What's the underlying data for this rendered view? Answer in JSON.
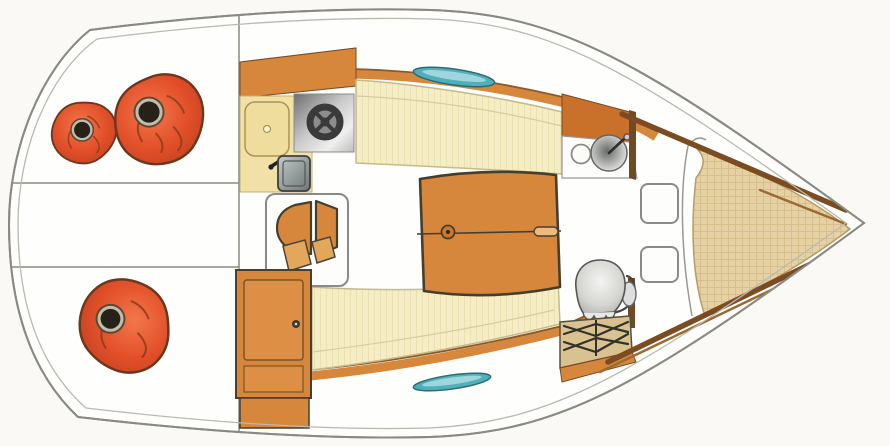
{
  "meta": {
    "title": "Sailboat interior floor plan, top-down view, bow pointing right",
    "diagram_type": "boat-floorplan",
    "orientation": "bow-right"
  },
  "colors": {
    "page-bg": "#FAF9F6",
    "hull-fill": "#FEFEFC",
    "hull-line": "#8A8A82",
    "inner-line": "#B9B9B0",
    "wood": "#D6873B",
    "wood-dark": "#C9702A",
    "wood-edge": "#7A4A22",
    "trim-brown": "#7B4B22",
    "cushion": "#F5EDC6",
    "cushion-edge": "#C6B98A",
    "counter": "#F1E1A6",
    "icebox": "#EEDD9C",
    "berth": "#E5D1A3",
    "berth-edge": "#B59C69",
    "net": "#D9C28F",
    "net-line": "#33312A",
    "window-teal": "#4FB0BC",
    "window-teal-light": "#9FD6DC",
    "window-edge": "#2F6A72",
    "pouf-orange": "#E2502A",
    "pouf-hole": "#262218",
    "pouf-ring": "#C2BCAC",
    "outline-dark": "#463E2D",
    "white": "#FDFDFB"
  },
  "components": {
    "cockpit": {
      "name": "cockpit",
      "bench_divider_lines": 2,
      "poufs": [
        {
          "name": "pouf-small-aft-top"
        },
        {
          "name": "pouf-large-aft-top"
        },
        {
          "name": "pouf-aft-bottom"
        }
      ]
    },
    "galley": {
      "name": "galley",
      "fixtures": [
        {
          "name": "icebox-lid"
        },
        {
          "name": "single-burner-stove"
        },
        {
          "name": "galley-sink"
        }
      ]
    },
    "saloon": {
      "name": "saloon",
      "fixtures": [
        {
          "name": "dining-table"
        },
        {
          "name": "settee-port"
        },
        {
          "name": "settee-starboard"
        },
        {
          "name": "companionway-steps"
        },
        {
          "name": "storage-cabinet"
        }
      ]
    },
    "head": {
      "name": "head-compartment",
      "fixtures": [
        {
          "name": "vanity-counter"
        },
        {
          "name": "washbasin"
        },
        {
          "name": "marine-toilet"
        },
        {
          "name": "storage-net"
        }
      ]
    },
    "forecabin": {
      "name": "forecabin",
      "fixtures": [
        {
          "name": "v-berth-cushion"
        },
        {
          "name": "locker-upper"
        },
        {
          "name": "locker-lower"
        },
        {
          "name": "hull-trim-strips"
        }
      ]
    },
    "windows": {
      "count": 2,
      "name": "deck-window"
    }
  }
}
